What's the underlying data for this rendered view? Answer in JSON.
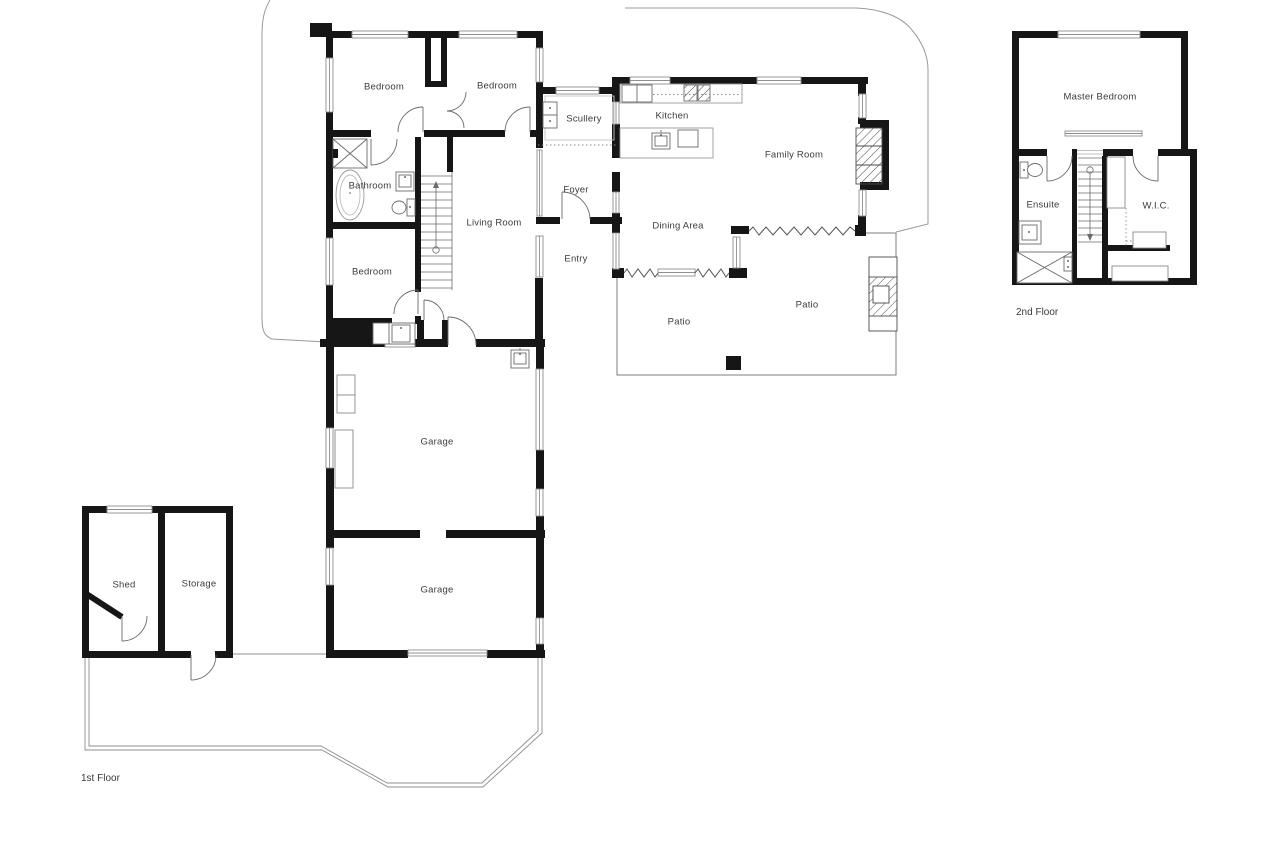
{
  "floor_plan": {
    "room_labels": [
      {
        "name": "Bedroom",
        "x": 384,
        "y": 87
      },
      {
        "name": "Bedroom",
        "x": 497,
        "y": 86
      },
      {
        "name": "Scullery",
        "x": 584,
        "y": 119
      },
      {
        "name": "Kitchen",
        "x": 672,
        "y": 116
      },
      {
        "name": "Family Room",
        "x": 794,
        "y": 155
      },
      {
        "name": "Bathroom",
        "x": 370,
        "y": 186
      },
      {
        "name": "Foyer",
        "x": 576,
        "y": 190
      },
      {
        "name": "Living Room",
        "x": 494,
        "y": 223
      },
      {
        "name": "Dining Area",
        "x": 678,
        "y": 226
      },
      {
        "name": "Entry",
        "x": 576,
        "y": 259
      },
      {
        "name": "Bedroom",
        "x": 372,
        "y": 272
      },
      {
        "name": "Patio",
        "x": 807,
        "y": 305
      },
      {
        "name": "Patio",
        "x": 679,
        "y": 322
      },
      {
        "name": "Garage",
        "x": 437,
        "y": 442
      },
      {
        "name": "Shed",
        "x": 124,
        "y": 585
      },
      {
        "name": "Storage",
        "x": 199,
        "y": 584
      },
      {
        "name": "Garage",
        "x": 437,
        "y": 590
      },
      {
        "name": "Master Bedroom",
        "x": 1100,
        "y": 97
      },
      {
        "name": "Ensuite",
        "x": 1043,
        "y": 205
      },
      {
        "name": "W.I.C.",
        "x": 1156,
        "y": 206
      }
    ],
    "floor_labels": [
      {
        "name": "1st Floor",
        "x": 81,
        "y": 773
      },
      {
        "name": "2nd Floor",
        "x": 1016,
        "y": 307
      }
    ],
    "colors": {
      "wall": "#161616",
      "fixture_line": "#6b6b6b",
      "window_line": "#8f8f8f",
      "boundary_line": "#9b9b9b",
      "text": "#3c3c3c",
      "background": "#ffffff"
    }
  }
}
